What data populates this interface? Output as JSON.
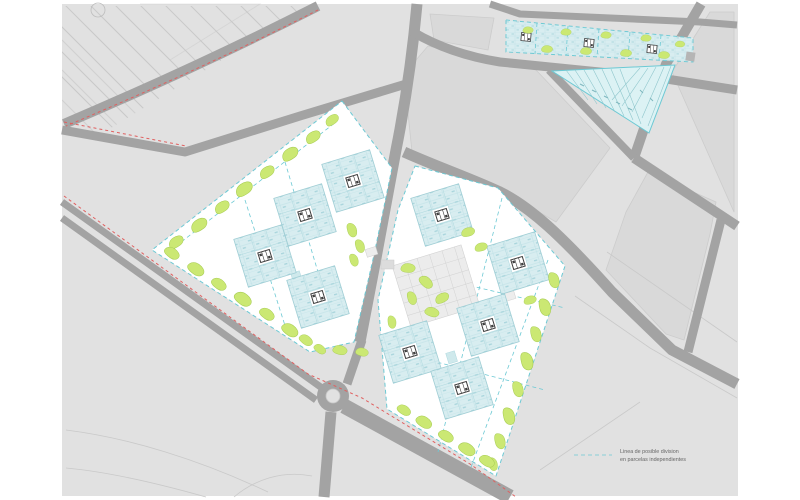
{
  "drawing": {
    "kind": "urban-development site plan",
    "legend": {
      "swatch": "cyan-dashed-line",
      "line1": "Linea de posible division",
      "line2": "en parcelas independientes"
    },
    "parcels": [
      {
        "id": "west-parcel",
        "blocks": 4
      },
      {
        "id": "east-parcel",
        "blocks": 5
      },
      {
        "id": "north-strip-building",
        "sections": 6,
        "plan_icons": 3
      },
      {
        "id": "triangle-parcel",
        "lots": 12
      }
    ]
  },
  "colors": {
    "background": "#e1e1e1",
    "cityblock": "#d9d9d9",
    "road": "#a3a3a3",
    "hatch_line": "#c9c9c9",
    "parcel": "#ffffff",
    "block": "#d8edf0",
    "block_grid": "#aed8de",
    "division_cyan": "#6cc9d4",
    "green": "#cbe873",
    "green_edge": "#a6cb52",
    "boundary_red": "#e06060",
    "icon": "#3c3c3c",
    "field_line": "#c9c9c9"
  }
}
